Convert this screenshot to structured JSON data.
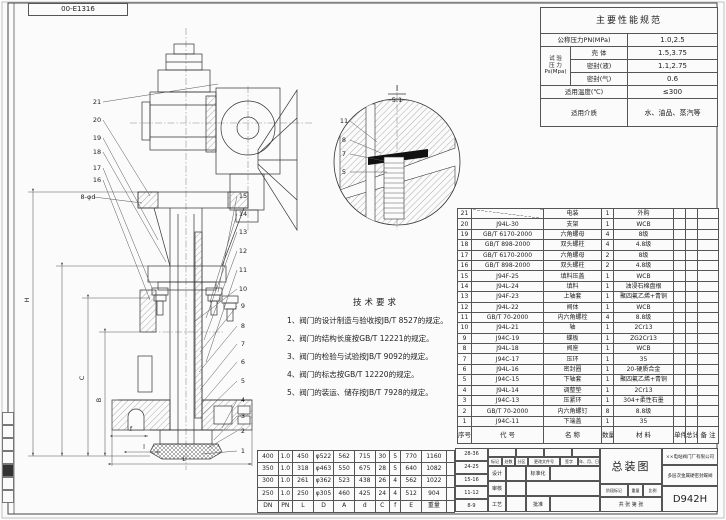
{
  "sheet": {
    "corner_label": "00-E1316"
  },
  "spec_table": {
    "title": "主要性能规范",
    "pn_label": "公称压力PN(MPa)",
    "pn_value": "1.0,2.5",
    "test_label_1": "试 验",
    "test_label_2": "压 力",
    "test_label_3": "Ps(Mpa)",
    "rows": [
      {
        "label": "壳 体",
        "value": "1.5,3.75"
      },
      {
        "label": "密封(液)",
        "value": "1.1,2.75"
      },
      {
        "label": "密封(气)",
        "value": "0.6"
      }
    ],
    "temp_label": "适用温度(℃)",
    "temp_value": "≤300",
    "media_label": "适用介质",
    "media_value": "水、油品、蒸汽等"
  },
  "tech_requirements": {
    "title": "技术要求",
    "items": [
      "1、阀门的设计制造与验收按JB/T 8527的规定。",
      "2、阀门的结构长度按GB/T 12221的规定。",
      "3、阀门的检验与试验按JB/T 9092的规定。",
      "4、阀门的标志按GB/T 12220的规定。",
      "5、阀门的装运、储存按JB/T 7928的规定。"
    ]
  },
  "parts_table": {
    "rows": [
      [
        "21",
        "",
        "电装",
        "1",
        "外购",
        "",
        "",
        ""
      ],
      [
        "20",
        "J94L-30",
        "支架",
        "1",
        "WCB",
        "",
        "",
        ""
      ],
      [
        "19",
        "GB/T 6170-2000",
        "六角螺母",
        "4",
        "8级",
        "",
        "",
        ""
      ],
      [
        "18",
        "GB/T 898-2000",
        "双头螺柱",
        "4",
        "4.8级",
        "",
        "",
        ""
      ],
      [
        "17",
        "GB/T 6170-2000",
        "六角螺母",
        "2",
        "8级",
        "",
        "",
        ""
      ],
      [
        "16",
        "GB/T 898-2000",
        "双头螺柱",
        "2",
        "4.8级",
        "",
        "",
        ""
      ],
      [
        "15",
        "J94F-25",
        "填料压盖",
        "1",
        "WCB",
        "",
        "",
        ""
      ],
      [
        "14",
        "J94L-24",
        "填料",
        "1",
        "油浸石棉盘根",
        "",
        "",
        ""
      ],
      [
        "13",
        "J94F-23",
        "上轴套",
        "1",
        "聚四氟乙烯+青铜",
        "",
        "",
        ""
      ],
      [
        "12",
        "J94L-22",
        "阀体",
        "1",
        "WCB",
        "",
        "",
        ""
      ],
      [
        "11",
        "GB/T 70-2000",
        "内六角螺栓",
        "4",
        "8.8级",
        "",
        "",
        ""
      ],
      [
        "10",
        "J94L-21",
        "轴",
        "1",
        "2Cr13",
        "",
        "",
        ""
      ],
      [
        "9",
        "J94C-19",
        "蝶板",
        "1",
        "ZG2Cr13",
        "",
        "",
        ""
      ],
      [
        "8",
        "J94L-18",
        "阀座",
        "1",
        "WCB",
        "",
        "",
        ""
      ],
      [
        "7",
        "J94C-17",
        "压环",
        "1",
        "35",
        "",
        "",
        ""
      ],
      [
        "6",
        "J94L-16",
        "密封圈",
        "1",
        "20-硬质合金",
        "",
        "",
        ""
      ],
      [
        "5",
        "J94C-15",
        "下轴套",
        "1",
        "聚四氟乙烯+青铜",
        "",
        "",
        ""
      ],
      [
        "4",
        "J94L-14",
        "调整垫",
        "1",
        "2Cr13",
        "",
        "",
        ""
      ],
      [
        "3",
        "J94C-13",
        "压紧环",
        "1",
        "304+柔性石墨",
        "",
        "",
        ""
      ],
      [
        "2",
        "GB/T 70-2000",
        "内六角螺钉",
        "8",
        "8.8级",
        "",
        "",
        ""
      ],
      [
        "1",
        "J94C-11",
        "下端盖",
        "1",
        "35",
        "",
        "",
        ""
      ],
      [
        "序号",
        "代  号",
        "名  称",
        "数量",
        "材  料",
        "单件",
        "总计",
        "备 注"
      ]
    ]
  },
  "dim_table": {
    "rows": [
      [
        "400",
        "1.0",
        "450",
        "φ522",
        "562",
        "715",
        "30",
        "5",
        "770",
        "1160",
        ""
      ],
      [
        "350",
        "1.0",
        "318",
        "φ463",
        "550",
        "675",
        "28",
        "5",
        "640",
        "1082",
        ""
      ],
      [
        "300",
        "1.0",
        "261",
        "φ362",
        "523",
        "438",
        "26",
        "4",
        "562",
        "1022",
        ""
      ],
      [
        "250",
        "1.0",
        "250",
        "φ305",
        "460",
        "425",
        "24",
        "4",
        "512",
        "904",
        ""
      ],
      [
        "DN",
        "PN",
        "L",
        "D",
        "A",
        "d",
        "C",
        "f",
        "E",
        "重量",
        ""
      ]
    ]
  },
  "title_block": {
    "zone_rows": [
      "28-36",
      "24-25",
      "15-16",
      "11-12",
      "8-9"
    ],
    "rev_labels": [
      "标记",
      "处数",
      "分区",
      "更改文件号",
      "签字",
      "年、月、日"
    ],
    "sig_design": "设计",
    "sig_standard": "标准化",
    "sig_check": "审核",
    "sig_process": "工艺",
    "sig_approve": "批准",
    "drawing_title": "总装图",
    "company": "××电站阀门厂有限公司",
    "product_name": "多层次金属硬密封蝶阀",
    "stage_label": "阶段标记",
    "weight_label": "重量",
    "scale_label": "比例",
    "sheets_text": "共 张 第 张",
    "model": "D942H"
  },
  "drawing": {
    "detail_view_label": "I",
    "detail_scale": "5:1",
    "callouts": [
      {
        "t": "21",
        "x": 97,
        "y": 104,
        "lx": 218,
        "ly": 84
      },
      {
        "t": "20",
        "x": 97,
        "y": 122,
        "lx": 150,
        "ly": 196
      },
      {
        "t": "19",
        "x": 97,
        "y": 140,
        "lx": 158,
        "ly": 240
      },
      {
        "t": "18",
        "x": 97,
        "y": 154,
        "lx": 166,
        "ly": 262
      },
      {
        "t": "17",
        "x": 97,
        "y": 170,
        "lx": 152,
        "ly": 288
      },
      {
        "t": "16",
        "x": 97,
        "y": 182,
        "lx": 150,
        "ly": 300
      },
      {
        "t": "8-φd",
        "x": 88,
        "y": 199,
        "lx": 142,
        "ly": 203
      },
      {
        "t": "15",
        "x": 243,
        "y": 198,
        "lx": 218,
        "ly": 292
      },
      {
        "t": "14",
        "x": 243,
        "y": 216,
        "lx": 210,
        "ly": 302
      },
      {
        "t": "13",
        "x": 243,
        "y": 234,
        "lx": 206,
        "ly": 318
      },
      {
        "t": "12",
        "x": 243,
        "y": 253,
        "lx": 204,
        "ly": 340
      },
      {
        "t": "11",
        "x": 243,
        "y": 272,
        "lx": 206,
        "ly": 362
      },
      {
        "t": "10",
        "x": 243,
        "y": 291,
        "lx": 194,
        "ly": 322
      },
      {
        "t": "9",
        "x": 243,
        "y": 308,
        "lx": 200,
        "ly": 352
      },
      {
        "t": "8",
        "x": 243,
        "y": 328,
        "lx": 199,
        "ly": 372
      },
      {
        "t": "7",
        "x": 243,
        "y": 346,
        "lx": 200,
        "ly": 390
      },
      {
        "t": "6",
        "x": 243,
        "y": 364,
        "lx": 201,
        "ly": 404
      },
      {
        "t": "5",
        "x": 243,
        "y": 383,
        "lx": 203,
        "ly": 414
      },
      {
        "t": "4",
        "x": 243,
        "y": 402,
        "lx": 222,
        "ly": 428
      },
      {
        "t": "3",
        "x": 243,
        "y": 418,
        "lx": 214,
        "ly": 440
      },
      {
        "t": "2",
        "x": 243,
        "y": 433,
        "lx": 208,
        "ly": 448
      },
      {
        "t": "1",
        "x": 243,
        "y": 453,
        "lx": 202,
        "ly": 454
      },
      {
        "t": "11",
        "x": 344,
        "y": 123,
        "lx": 377,
        "ly": 142
      },
      {
        "t": "8",
        "x": 344,
        "y": 142,
        "lx": 381,
        "ly": 153
      },
      {
        "t": "7",
        "x": 344,
        "y": 156,
        "lx": 384,
        "ly": 161
      },
      {
        "t": "5",
        "x": 344,
        "y": 174,
        "lx": 387,
        "ly": 172
      }
    ],
    "dim_labels": [
      {
        "t": "H",
        "x": 29,
        "y": 300,
        "r": -90
      },
      {
        "t": "C",
        "x": 84,
        "y": 378,
        "r": -90
      },
      {
        "t": "B",
        "x": 101,
        "y": 400,
        "r": -90
      },
      {
        "t": "f",
        "x": 131,
        "y": 431,
        "r": 0
      },
      {
        "t": "l",
        "x": 144,
        "y": 449,
        "r": 0
      },
      {
        "t": "L",
        "x": 184,
        "y": 461,
        "r": 0
      }
    ]
  }
}
